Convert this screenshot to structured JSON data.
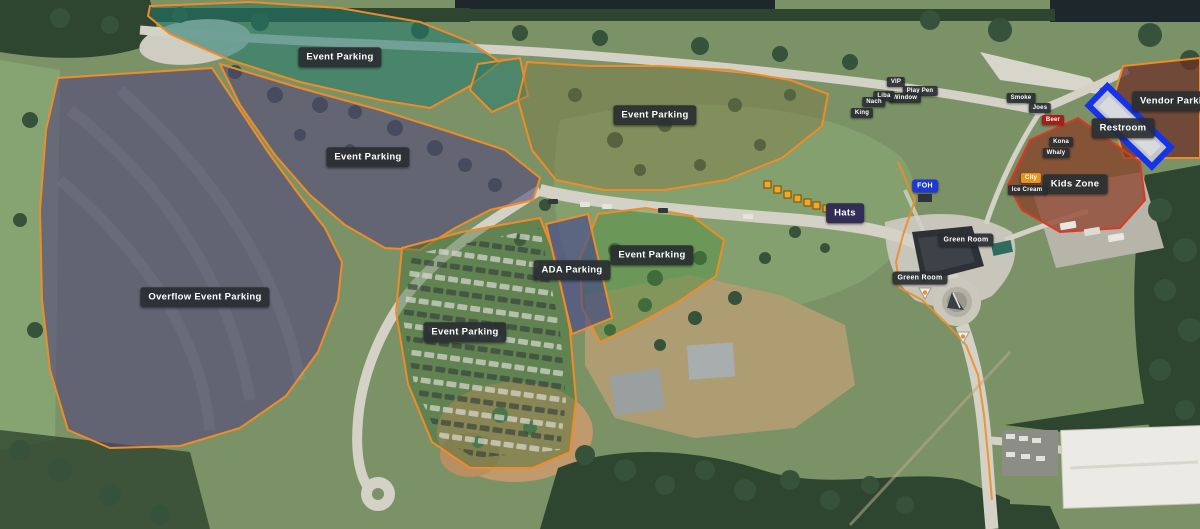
{
  "map": {
    "description_colors": {
      "zone_border_orange": "#f08c28",
      "kids_zone_border_red": "#d93a25",
      "restroom_border_blue": "#1733e8",
      "label_background": "#2a2e32",
      "foh_label_blue": "#2038d0",
      "hats_label_navy": "#312d55",
      "beer_label_red": "#a81d14",
      "city_label_orange": "#e89420"
    },
    "hats_stall_count": 7
  },
  "zones": [
    {
      "name": "event-parking-northwest",
      "label": "Event Parking"
    },
    {
      "name": "event-parking-north",
      "label": "Event Parking"
    },
    {
      "name": "event-parking-west",
      "label": "Event Parking"
    },
    {
      "name": "overflow-event-parking",
      "label": "Overflow Event Parking"
    },
    {
      "name": "ada-parking",
      "label": "ADA Parking"
    },
    {
      "name": "event-parking-center",
      "label": "Event Parking"
    },
    {
      "name": "event-parking-south",
      "label": "Event Parking"
    },
    {
      "name": "vendor-parking",
      "label": "Vendor Parking"
    },
    {
      "name": "restroom",
      "label": "Restroom"
    },
    {
      "name": "kids-zone",
      "label": "Kids Zone"
    },
    {
      "name": "hats",
      "label": "Hats"
    },
    {
      "name": "foh",
      "label": "FOH"
    },
    {
      "name": "green-room-upper",
      "label": "Green Room"
    },
    {
      "name": "green-room-lower",
      "label": "Green Room"
    }
  ],
  "vendor_markers": [
    {
      "name": "vip",
      "label": "VIP"
    },
    {
      "name": "play-pen",
      "label": "Play Pen"
    },
    {
      "name": "window",
      "label": "Window"
    },
    {
      "name": "liba",
      "label": "Liba"
    },
    {
      "name": "nach",
      "label": "Nach"
    },
    {
      "name": "king",
      "label": "King"
    },
    {
      "name": "smoke",
      "label": "Smoke"
    },
    {
      "name": "joes",
      "label": "Joes"
    },
    {
      "name": "beer",
      "label": "Beer"
    },
    {
      "name": "kona",
      "label": "Kona"
    },
    {
      "name": "whaly",
      "label": "Whaly"
    },
    {
      "name": "city",
      "label": "City"
    },
    {
      "name": "ice-cream",
      "label": "Ice Cream"
    }
  ]
}
